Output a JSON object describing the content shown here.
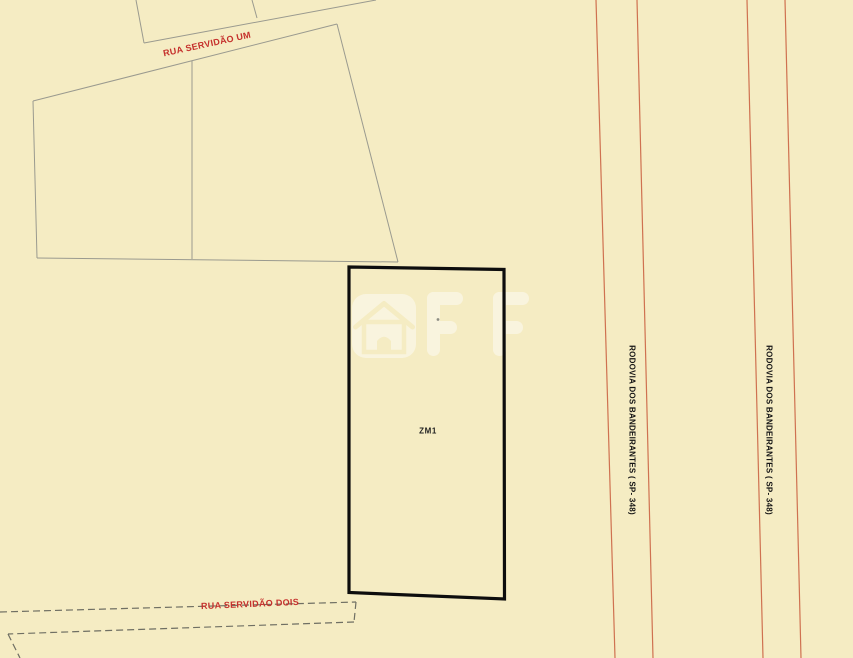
{
  "map": {
    "background_color": "#f5ecc3",
    "zone_parcel": {
      "label": "ZM1",
      "outline_color": "#0d0d0d"
    },
    "streets": [
      {
        "name": "RUA SERVIDÃO UM",
        "label_color": "#c5302c",
        "line_style": "solid-gray"
      },
      {
        "name": "RUA SERVIDÃO DOIS",
        "label_color": "#c5302c",
        "line_style": "dashed-gray"
      }
    ],
    "highways": [
      {
        "name": "RODOVIA DOS BANDEIRANTES ( SP- 348)",
        "line_color": "#cf7150"
      },
      {
        "name": "RODOVIA DOS BANDEIRANTES ( SP- 348)",
        "line_color": "#cf7150"
      }
    ],
    "watermark": {
      "text": "OFF",
      "icon": "house-in-rounded-square",
      "color": "#ffffff"
    },
    "colors": {
      "parcel_line": "#9a9a8f",
      "dashed_line": "#6f6f63",
      "street_label": "#c5302c",
      "highway_line": "#cf7150",
      "zone_outline": "#0d0d0d"
    }
  }
}
